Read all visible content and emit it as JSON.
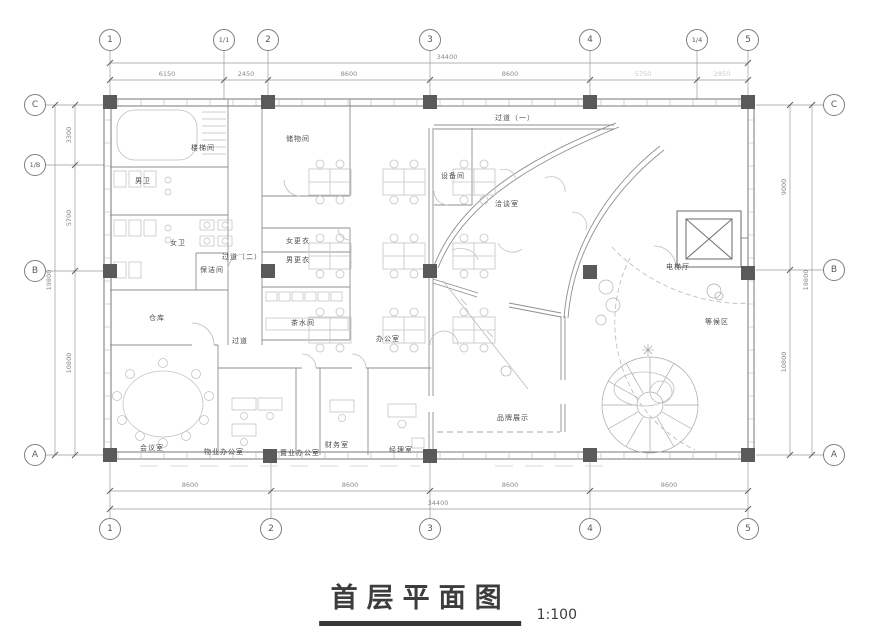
{
  "title": {
    "text": "首层平面图",
    "scale": "1:100"
  },
  "grid": {
    "top": [
      "1",
      "1/1",
      "2",
      "3",
      "4",
      "1/4",
      "5"
    ],
    "bottom": [
      "1",
      "2",
      "3",
      "4",
      "5"
    ],
    "left": [
      "C",
      "1/B",
      "B",
      "A"
    ],
    "right": [
      "C",
      "B",
      "A"
    ]
  },
  "dims": {
    "top_overall": "34400",
    "top_segments": [
      "6150",
      "2450",
      "8600",
      "8600",
      "5750",
      "2850"
    ],
    "bottom_overall": "34400",
    "bottom_segments": [
      "8600",
      "8600",
      "8600",
      "8600"
    ],
    "left_overall": "19800",
    "left_segments": [
      "3300",
      "5700",
      "10800"
    ],
    "right_overall": "19800",
    "right_segments": [
      "9000",
      "10800"
    ]
  },
  "rooms": {
    "stair": "楼梯间",
    "mens_wc": "男卫",
    "womens_wc": "女卫",
    "storage": "储物间",
    "women_change": "女更衣",
    "men_change": "男更衣",
    "pantry": "茶水间",
    "corridor2": "过道（二）",
    "cleaning": "保洁间",
    "warehouse": "仓库",
    "aisle": "过道",
    "meeting": "会议室",
    "property_office": "物业办公室",
    "sales_office": "置业办公室",
    "finance": "财务室",
    "manager": "经理室",
    "office": "办公室",
    "corridor1": "过道（一）",
    "equipment": "设备间",
    "negotiation": "洽谈室",
    "elevator_hall": "电梯厅",
    "waiting": "等候区",
    "brand_display": "品牌展示"
  },
  "colors": {
    "wall": "#8f8f8f",
    "outer_wall": "#777777",
    "column": "#5a5a5a",
    "furniture": "#c4c4c4",
    "text": "#4a4a4a",
    "title": "#383838"
  }
}
